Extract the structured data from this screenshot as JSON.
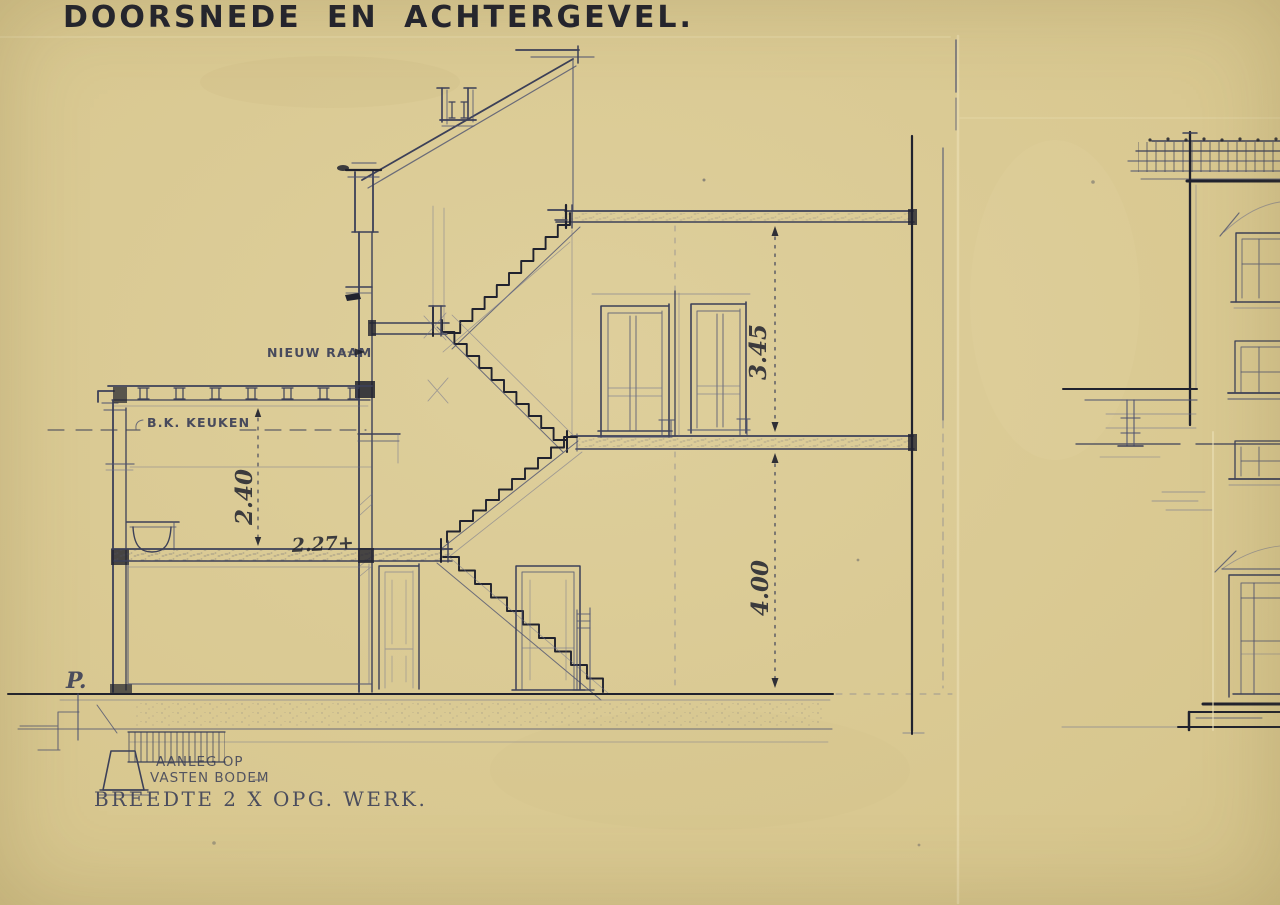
{
  "title": "DOORSNEDE EN ACHTERGEVEL.",
  "labels": {
    "nieuw_raam": "NIEUW RAAM",
    "bk_keuken": "B.K. KEUKEN",
    "p_mark": "P.",
    "aanleg_op": "AANLEG OP",
    "vasten_bodem": "VASTEN BODEM",
    "breedte": "BREEDTE 2 X OPG. WERK."
  },
  "dimensions": {
    "kitchen_ceiling_height": "2.40",
    "kitchen_floor_level": "2.27+",
    "upper_storey": "3.45",
    "ground_storey": "4.00"
  },
  "colors": {
    "paper": "#d9c893",
    "paper-light": "#e3d4a0",
    "paper-shadow": "#c9b87e",
    "ink-strong": "#20222e",
    "ink": "#3c4058",
    "ink-medium": "#4d5270",
    "ink-faint": "#6b708e",
    "scan-black": "#0b0b0b",
    "scan-white": "#f6f4ea"
  }
}
